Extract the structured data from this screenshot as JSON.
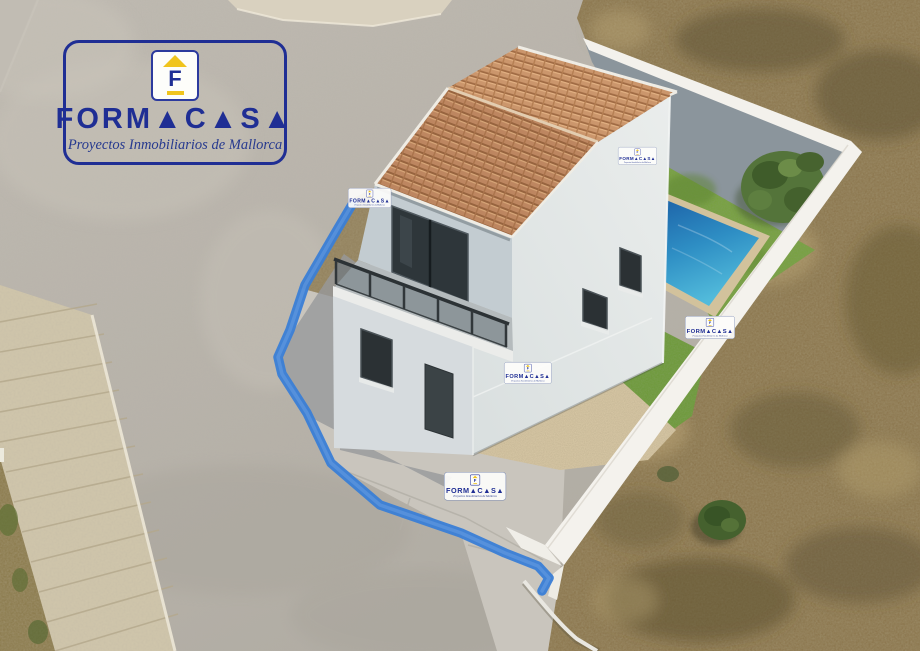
{
  "logo": {
    "brand": "FORMACASA",
    "brand_display": "FORM▲C▲S▲",
    "tagline": "Proyectos Inmobiliarios de Mallorca",
    "icon_letter": "F",
    "blue": "#1f2e94",
    "yellow": "#f0c41d"
  },
  "watermarks": {
    "items": [
      {
        "variant": "main",
        "x": 63,
        "y": 40,
        "s": 1
      },
      {
        "variant": "small",
        "x": 348,
        "y": 188,
        "s": 0.195
      },
      {
        "variant": "small",
        "x": 618,
        "y": 147,
        "s": 0.175
      },
      {
        "variant": "small",
        "x": 504,
        "y": 362,
        "s": 0.215
      },
      {
        "variant": "small",
        "x": 685,
        "y": 316,
        "s": 0.225
      },
      {
        "variant": "small",
        "x": 444,
        "y": 472,
        "s": 0.28
      }
    ]
  },
  "scene": {
    "description": "Aerial drone view of a two-storey white house with terracotta tiled roof, walled garden with swimming pool, artificial lawn and tree, gravel patio, surrounding road and dry field; plot boundary painted blue",
    "palette": {
      "road": "#b8b3aa",
      "sidewalk_pavers": "#cfc5ab",
      "dry_field": "#8d7850",
      "grass": "#79a142",
      "pool_dark": "#1d63a8",
      "pool_light": "#52bbdb",
      "pool_coping": "#d2c29c",
      "roof_tile": "#bd8660",
      "garden_wall_white": "#f3f1ec",
      "wall_shadow_face": "#8b959c",
      "house_wall_lit": "#e4e8e7",
      "house_wall_shade": "#c3ccd1",
      "window_glass": "#2b3134",
      "gravel": "#d5c5a3",
      "concrete_apron": "#c9c5bd",
      "boundary_line_blue": "#3a7ed6"
    }
  }
}
